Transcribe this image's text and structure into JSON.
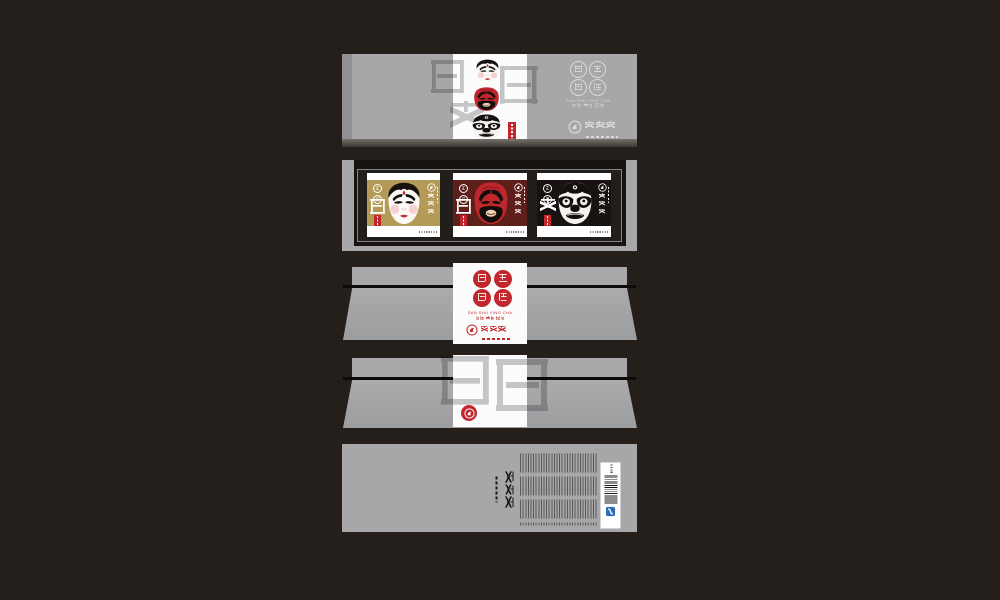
{
  "page_background": "#241f1a",
  "brand": {
    "seal_chars": [
      "三",
      "蜀",
      "英",
      "茶"
    ],
    "romanized": "SAN SHU YING CHA",
    "tea_types_line": "红茶·绿茶·花茶",
    "logo_name": "味之至",
    "watermark_front_chars": [
      "仁",
      "義",
      "勇"
    ],
    "watermark_side_chars": [
      "三",
      "英"
    ]
  },
  "tray": {
    "cards": [
      {
        "virtue": "仁",
        "mask": "white-face-opera-mask",
        "background": "#b49a57",
        "stamps": [
          "蜀",
          "茶"
        ]
      },
      {
        "virtue": "義",
        "mask": "red-face-opera-mask",
        "background": "#5e1f1b",
        "stamps": [
          "蜀",
          "茶"
        ]
      },
      {
        "virtue": "勇",
        "mask": "black-face-opera-mask",
        "background": "#181310",
        "stamps": [
          "蜀",
          "茶"
        ]
      }
    ]
  },
  "colors": {
    "panel_gray": "#a7a7a9",
    "accent_red": "#c1272d",
    "gold": "#b49a57",
    "maroon": "#5e1f1b",
    "card_black": "#181310",
    "qs_blue": "#2e6fb7",
    "white": "#fcfcfc"
  }
}
